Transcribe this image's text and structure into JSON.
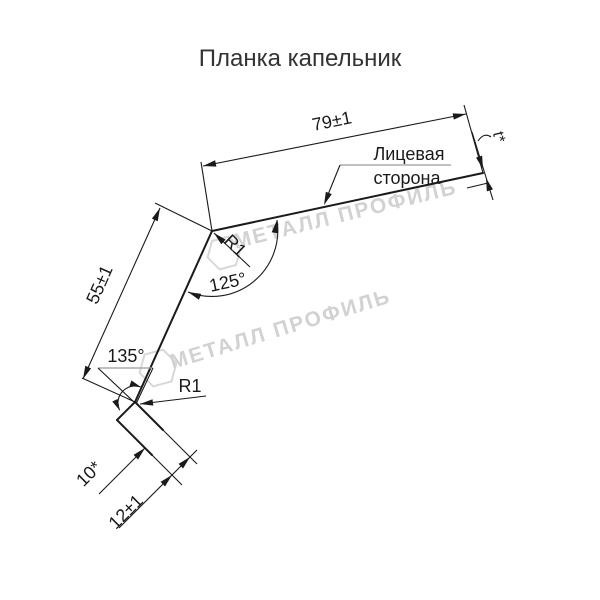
{
  "title": "Планка капельник",
  "drawing": {
    "labels": {
      "width_top": "79±1",
      "thickness": "t*",
      "face_side_line1": "Лицевая",
      "face_side_line2": "сторона",
      "radius_top": "R1",
      "angle_top": "125°",
      "height_left": "55±1",
      "angle_bottom": "135°",
      "radius_bottom": "R1",
      "lip_length": "10*",
      "lip_width": "12±1"
    },
    "watermark": {
      "text": "МЕТАЛЛ ПРОФИЛЬ",
      "color": "#d2d2d2"
    },
    "colors": {
      "line": "#1a1a1a",
      "leader_shoulder": "#9a9a9a",
      "title_text": "#333333"
    }
  }
}
